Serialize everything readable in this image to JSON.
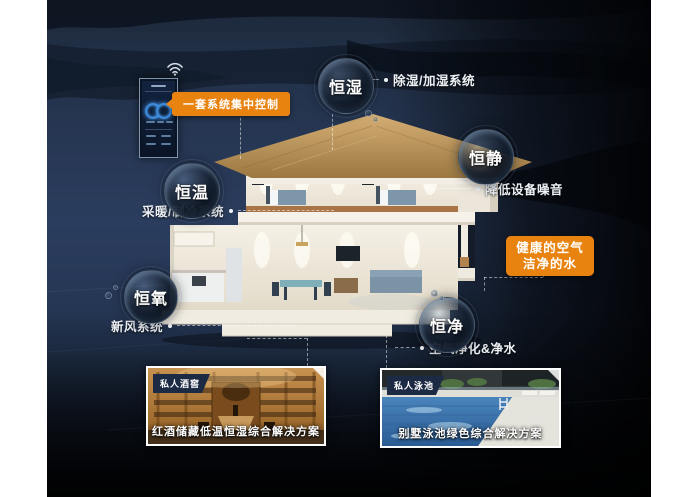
{
  "colors": {
    "background_navy": "#2b3d5e",
    "background_dark": "#0a0f18",
    "accent_orange": "#e8830f",
    "label_text": "#eef2f6",
    "photo_tag_bg": "#1c2a44"
  },
  "control_panel": {
    "badge_label": "一套系统集中控制",
    "wifi_icon": "wifi-signal"
  },
  "bubbles": {
    "humidity": {
      "label": "恒湿",
      "desc": "除湿/加湿系统"
    },
    "quiet": {
      "label": "恒静",
      "desc": "降低设备噪音"
    },
    "temperature": {
      "label": "恒温",
      "desc": "采暖/制冷系统"
    },
    "oxygen": {
      "label": "恒氧",
      "desc": "新风系统"
    },
    "purity": {
      "label": "恒净",
      "desc": "空气净化&净水"
    }
  },
  "highlight_badge": {
    "line1": "健康的空气",
    "line2": "洁净的水"
  },
  "photos": {
    "wine": {
      "tag": "私人酒窖",
      "caption": "红酒储藏低温恒湿综合解决方案"
    },
    "pool": {
      "tag": "私人泳池",
      "caption": "别墅泳池绿色综合解决方案"
    }
  }
}
